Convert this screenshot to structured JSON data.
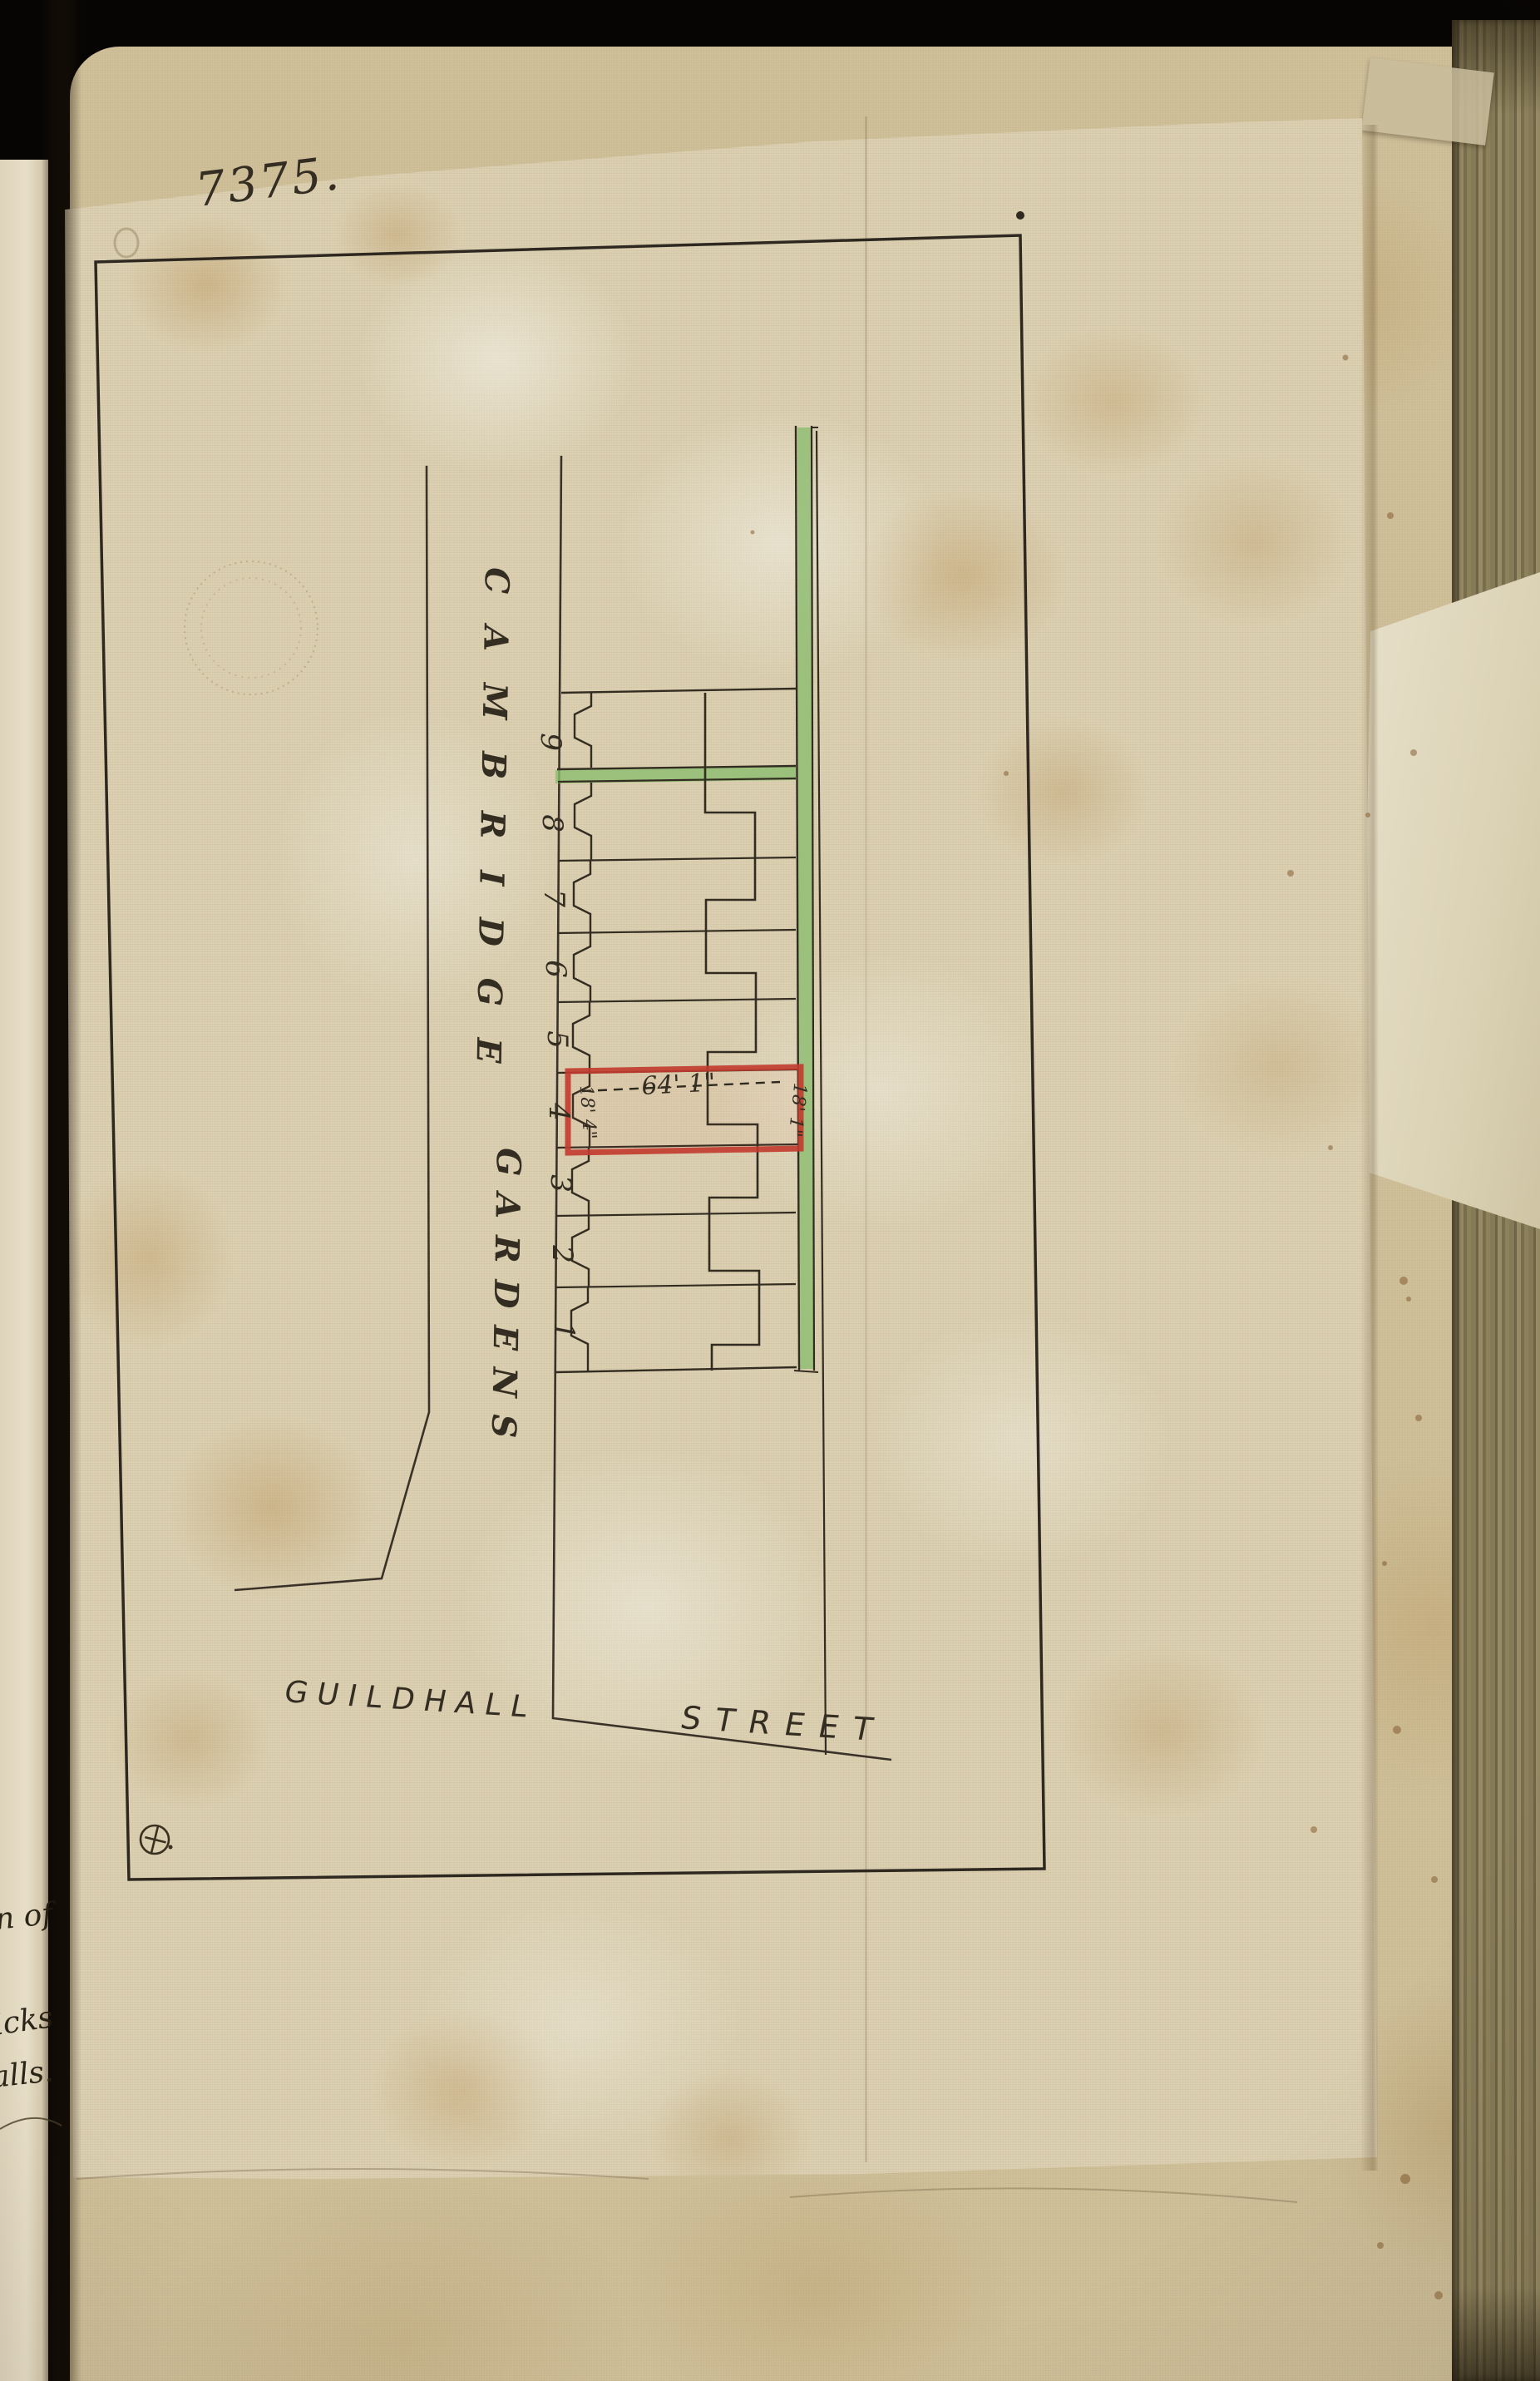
{
  "document": {
    "reference_number": "7375.",
    "plan": {
      "road_name_word1": "CAMBRIDGE",
      "road_name_word2": "GARDENS",
      "street_name_word1": "GUILDHALL",
      "street_name_word2": "STREET",
      "plot_numbers": [
        "9",
        "8",
        "7",
        "6",
        "5",
        "4",
        "3",
        "2",
        "1"
      ],
      "highlighted_plot": {
        "frontage_dimension": "64' 1\"",
        "left_depth_dimension": "18' 4\"",
        "right_depth_dimension": "18' 1\""
      },
      "colors": {
        "highlight_outline": "#c23b2e",
        "road_fill": "#8cbd6f",
        "ink": "#342d22"
      }
    },
    "adjacent_page_fragments": [
      "ation of",
      "icks",
      "alls."
    ]
  }
}
